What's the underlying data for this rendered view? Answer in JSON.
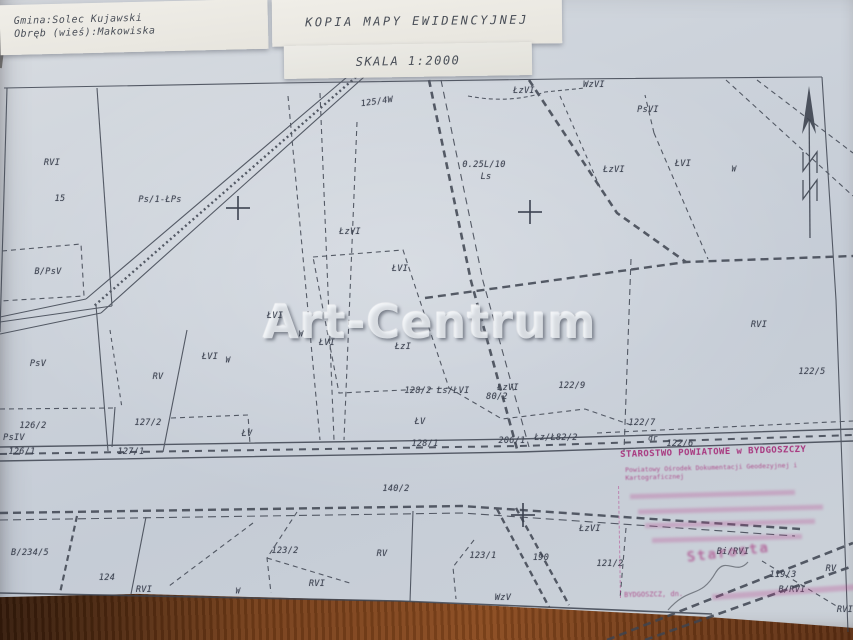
{
  "header": {
    "municipality": "Gmina:Solec Kujawski",
    "district": "Obręb (wieś):Makowiska",
    "title": "KOPIA MAPY EWIDENCYJNEJ",
    "scale": "SKALA 1:2000"
  },
  "watermark": "Art-Centrum",
  "stamp": {
    "line1": "STAROSTWO POWIATOWE w BYDGOSZCZY",
    "line2": "Powiatowy Ośrodek Dokumentacji Geodezyjnej i Kartograficznej",
    "city_date": "BYDGOSZCZ, dn.",
    "signature": "Starosta",
    "color": "#a8377f"
  },
  "map": {
    "ink_color": "#3c4250",
    "paper_color": "#ccd2d9",
    "labels": [
      {
        "text": "RVI",
        "x": 52,
        "y": 163
      },
      {
        "text": "15",
        "x": 60,
        "y": 199
      },
      {
        "text": "Ps/1-ŁPs",
        "x": 160,
        "y": 200
      },
      {
        "text": "B/PsV",
        "x": 48,
        "y": 272
      },
      {
        "text": "PsV",
        "x": 38,
        "y": 364
      },
      {
        "text": "RV",
        "x": 158,
        "y": 377
      },
      {
        "text": "ŁVI",
        "x": 210,
        "y": 357
      },
      {
        "text": "W",
        "x": 228,
        "y": 360,
        "size": 7.5
      },
      {
        "text": "126/2",
        "x": 33,
        "y": 426
      },
      {
        "text": "PsIV",
        "x": 14,
        "y": 438
      },
      {
        "text": "126/1",
        "x": 22,
        "y": 452
      },
      {
        "text": "127/2",
        "x": 148,
        "y": 423
      },
      {
        "text": "127/1",
        "x": 131,
        "y": 452
      },
      {
        "text": "ŁV",
        "x": 247,
        "y": 434
      },
      {
        "text": "125/4W",
        "x": 377,
        "y": 102,
        "rot": -8
      },
      {
        "text": "ŁzVI",
        "x": 350,
        "y": 232
      },
      {
        "text": "ŁVI",
        "x": 275,
        "y": 316
      },
      {
        "text": "W",
        "x": 301,
        "y": 334,
        "size": 7.5
      },
      {
        "text": "ŁVI",
        "x": 327,
        "y": 343
      },
      {
        "text": "ŁzI",
        "x": 403,
        "y": 347
      },
      {
        "text": "ŁVI",
        "x": 400,
        "y": 269
      },
      {
        "text": "ŁzVI",
        "x": 524,
        "y": 91
      },
      {
        "text": "WzVI",
        "x": 594,
        "y": 85
      },
      {
        "text": "PsVI",
        "x": 648,
        "y": 110
      },
      {
        "text": "0.25L/10",
        "x": 484,
        "y": 165
      },
      {
        "text": "Ls",
        "x": 486,
        "y": 177
      },
      {
        "text": "ŁzVI",
        "x": 614,
        "y": 170
      },
      {
        "text": "ŁVI",
        "x": 683,
        "y": 164
      },
      {
        "text": "W",
        "x": 734,
        "y": 169,
        "size": 7.5
      },
      {
        "text": "122/9",
        "x": 572,
        "y": 386
      },
      {
        "text": "ŁzVI",
        "x": 508,
        "y": 388
      },
      {
        "text": "80/2",
        "x": 497,
        "y": 397
      },
      {
        "text": "128/2 Ls/ŁVI",
        "x": 437,
        "y": 391
      },
      {
        "text": "ŁV",
        "x": 420,
        "y": 422
      },
      {
        "text": "128/1",
        "x": 425,
        "y": 444
      },
      {
        "text": "206/1",
        "x": 512,
        "y": 441
      },
      {
        "text": "Łz/Ł82/2",
        "x": 556,
        "y": 438
      },
      {
        "text": "122/7",
        "x": 642,
        "y": 423
      },
      {
        "text": "dr",
        "x": 653,
        "y": 438,
        "size": 7.5
      },
      {
        "text": "122/6",
        "x": 680,
        "y": 444
      },
      {
        "text": "RVI",
        "x": 759,
        "y": 325
      },
      {
        "text": "122/5",
        "x": 812,
        "y": 372
      },
      {
        "text": "140/2",
        "x": 396,
        "y": 489
      },
      {
        "text": "123/2",
        "x": 285,
        "y": 551
      },
      {
        "text": "RV",
        "x": 382,
        "y": 554
      },
      {
        "text": "RVI",
        "x": 317,
        "y": 584
      },
      {
        "text": "123/1",
        "x": 483,
        "y": 556
      },
      {
        "text": "WzV",
        "x": 503,
        "y": 598
      },
      {
        "text": "190",
        "x": 541,
        "y": 558
      },
      {
        "text": "ŁzVI",
        "x": 590,
        "y": 529
      },
      {
        "text": "121/2",
        "x": 610,
        "y": 564
      },
      {
        "text": "B/234/5",
        "x": 30,
        "y": 553
      },
      {
        "text": "124",
        "x": 107,
        "y": 578
      },
      {
        "text": "RVI",
        "x": 144,
        "y": 590
      },
      {
        "text": "W",
        "x": 238,
        "y": 591,
        "size": 7.5
      },
      {
        "text": "Bi/RVI",
        "x": 733,
        "y": 552
      },
      {
        "text": "RV",
        "x": 831,
        "y": 569
      },
      {
        "text": "119/3",
        "x": 783,
        "y": 575
      },
      {
        "text": "B/RVI",
        "x": 792,
        "y": 590
      },
      {
        "text": "RVI",
        "x": 845,
        "y": 610
      }
    ],
    "grid_crosses": [
      {
        "x": 238,
        "y": 208
      },
      {
        "x": 530,
        "y": 212
      },
      {
        "x": 523,
        "y": 515
      }
    ]
  }
}
